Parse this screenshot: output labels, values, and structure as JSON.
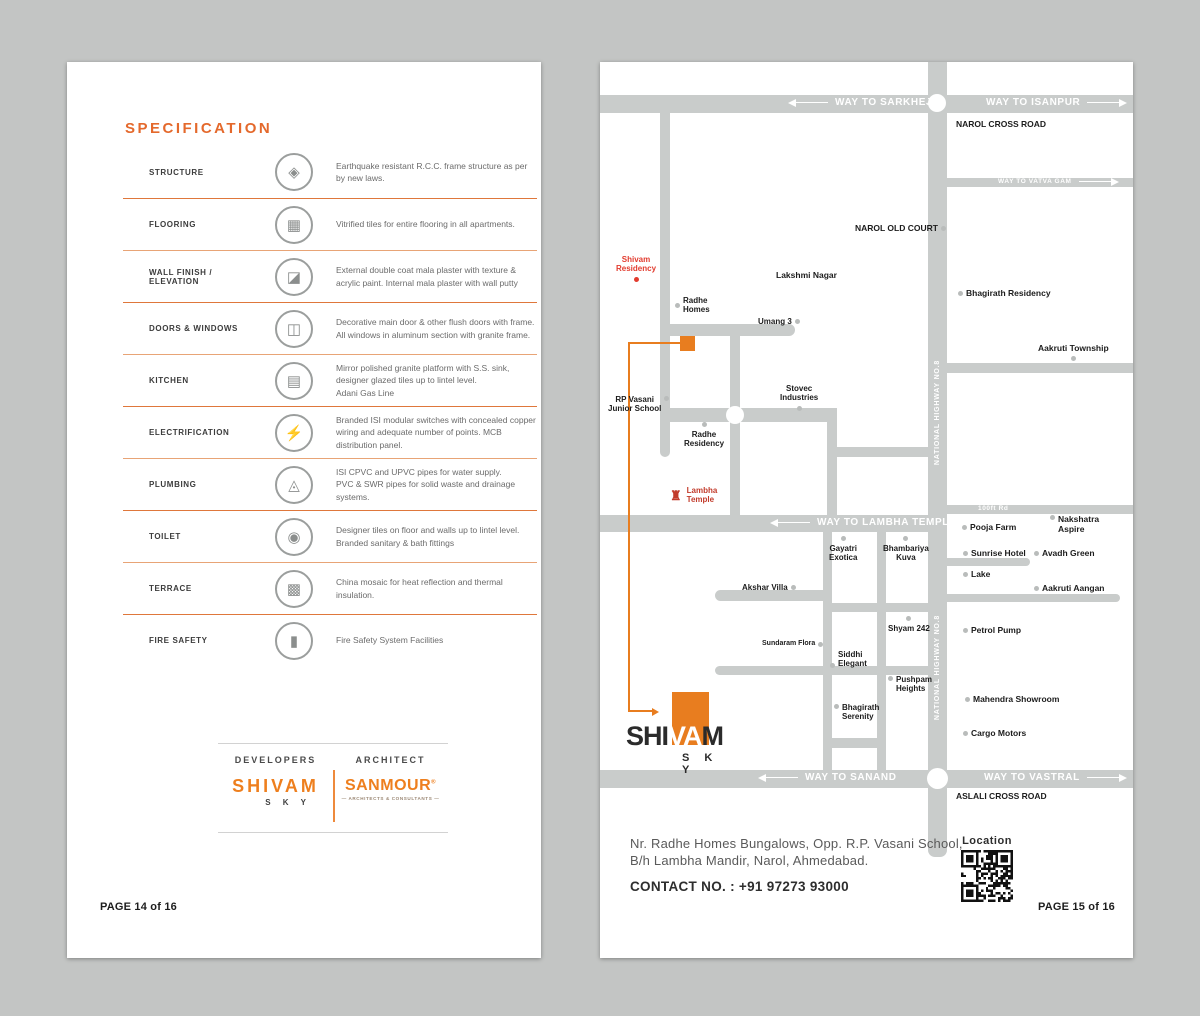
{
  "background": "#c3c5c4",
  "accent": "#e87b2d",
  "left_page": {
    "title": "SPECIFICATION",
    "page_number": "PAGE 14 of 16",
    "developers_label": "DEVELOPERS",
    "architect_label": "ARCHITECT",
    "developer_logo": {
      "name": "SHIVAM",
      "sub": "S K Y"
    },
    "architect_logo": {
      "name": "SANMOUR",
      "reg": "®",
      "tagline": "— ARCHITECTS & CONSULTANTS —"
    },
    "spec_items": [
      {
        "label": "STRUCTURE",
        "icon": "◈",
        "icon_name": "layers-icon",
        "desc": "Earthquake resistant R.C.C. frame structure as per by new laws."
      },
      {
        "label": "FLOORING",
        "icon": "▦",
        "icon_name": "tiles-icon",
        "desc": "Vitrified tiles for entire flooring in all apartments."
      },
      {
        "label": "WALL FINISH / ELEVATION",
        "icon": "◪",
        "icon_name": "plaster-icon",
        "desc": "External double coat mala plaster with texture & acrylic paint. Internal mala plaster with wall putty"
      },
      {
        "label": "DOORS & WINDOWS",
        "icon": "◫",
        "icon_name": "door-icon",
        "desc": "Decorative main door & other flush doors with frame. All windows in aluminum section with granite frame."
      },
      {
        "label": "KITCHEN",
        "icon": "▤",
        "icon_name": "stove-icon",
        "desc": "Mirror polished granite platform with S.S. sink, designer glazed tiles up to lintel level.\nAdani Gas Line"
      },
      {
        "label": "ELECTRIFICATION",
        "icon": "⚡",
        "icon_name": "lightning-icon",
        "desc": "Branded ISI modular switches with concealed copper wiring and adequate number of points. MCB distribution panel."
      },
      {
        "label": "PLUMBING",
        "icon": "◬",
        "icon_name": "shower-icon",
        "desc": "ISI CPVC and UPVC pipes for water supply.\nPVC & SWR pipes for solid waste and drainage systems."
      },
      {
        "label": "TOILET",
        "icon": "◉",
        "icon_name": "toilet-icon",
        "desc": "Designer tiles on floor and walls up to lintel level.\nBranded sanitary & bath fittings"
      },
      {
        "label": "TERRACE",
        "icon": "▩",
        "icon_name": "mosaic-icon",
        "desc": "China mosaic for heat reflection and thermal insulation."
      },
      {
        "label": "FIRE SAFETY",
        "icon": "▮",
        "icon_name": "extinguisher-icon",
        "desc": "Fire Safety System Facilities"
      }
    ]
  },
  "right_page": {
    "page_number": "PAGE 15 of 16",
    "address_line1": "Nr. Radhe Homes Bungalows, Opp. R.P. Vasani School,",
    "address_line2": "B/h Lambha Mandir, Narol, Ahmedabad.",
    "contact": "CONTACT NO. : +91 97273 93000",
    "qr_label": "Location",
    "map": {
      "highway_label": "NATIONAL HIGHWAY NO.8",
      "site_logo": {
        "pre": "SHI",
        "mid": "VA",
        "post": "M",
        "sub": "S K Y"
      },
      "road_labels": [
        {
          "text": "WAY TO SARKHEJ",
          "x": 196,
          "y": 35,
          "arrow": "left",
          "fs": 10
        },
        {
          "text": "WAY TO ISANPUR",
          "x": 386,
          "y": 35,
          "arrow": "right",
          "fs": 10
        },
        {
          "text": "WAY TO VATVA GAM",
          "x": 398,
          "y": 116,
          "arrow": "right",
          "fs": 6.5
        },
        {
          "text": "WAY TO LAMBHA TEMPLE",
          "x": 178,
          "y": 455,
          "arrow": "left",
          "fs": 10
        },
        {
          "text": "100ft Rd",
          "x": 378,
          "y": 443,
          "arrow": "none",
          "fs": 6.5
        },
        {
          "text": "WAY TO SANAND",
          "x": 166,
          "y": 710,
          "arrow": "left",
          "fs": 10
        },
        {
          "text": "WAY TO VASTRAL",
          "x": 384,
          "y": 710,
          "arrow": "right",
          "fs": 10
        }
      ],
      "places": [
        {
          "name": "NAROL CROSS ROAD",
          "x": 356,
          "y": 57,
          "dot": "none",
          "fs": 8.5
        },
        {
          "name": "NAROL OLD COURT",
          "x": 255,
          "y": 161,
          "dot": "right",
          "fs": 8.5
        },
        {
          "name": "Lakshmi Nagar",
          "x": 176,
          "y": 208,
          "dot": "none",
          "fs": 8.5
        },
        {
          "name": "Shivam\nResidency",
          "x": 16,
          "y": 193,
          "dot": "below",
          "red": true,
          "center": true
        },
        {
          "name": "Radhe\nHomes",
          "x": 75,
          "y": 234,
          "dot": "left"
        },
        {
          "name": "Umang 3",
          "x": 158,
          "y": 255,
          "dot": "right"
        },
        {
          "name": "Bhagirath Residency",
          "x": 358,
          "y": 226,
          "dot": "left",
          "fs": 8.5
        },
        {
          "name": "Aakruti Township",
          "x": 438,
          "y": 281,
          "dot": "below",
          "center": true,
          "fs": 8.5
        },
        {
          "name": "RP Vasani\nJunior School",
          "x": 8,
          "y": 333,
          "dot": "right",
          "dotpos": "top",
          "center": true
        },
        {
          "name": "Stovec\nIndustries",
          "x": 180,
          "y": 322,
          "dot": "below",
          "center": true
        },
        {
          "name": "Radhe\nResidency",
          "x": 84,
          "y": 360,
          "dot": "above",
          "center": true
        },
        {
          "name": "Lambha\nTemple",
          "x": 70,
          "y": 424,
          "dot": "temple"
        },
        {
          "name": "Akshar Villa",
          "x": 142,
          "y": 521,
          "dot": "right"
        },
        {
          "name": "Gayatri\nExotica",
          "x": 229,
          "y": 474,
          "dot": "above",
          "center": true
        },
        {
          "name": "Bhambariya\nKuva",
          "x": 283,
          "y": 474,
          "dot": "above",
          "center": true
        },
        {
          "name": "Sundaram Flora",
          "x": 162,
          "y": 578,
          "dot": "right",
          "fs": 7
        },
        {
          "name": "Siddhi\nElegant",
          "x": 230,
          "y": 588,
          "dot": "left",
          "dotpos": "bot"
        },
        {
          "name": "Shyam 242",
          "x": 288,
          "y": 554,
          "dot": "above",
          "center": true
        },
        {
          "name": "Pushpam\nHeights",
          "x": 288,
          "y": 613,
          "dot": "left",
          "dotpos": "top"
        },
        {
          "name": "Bhagirath\nSerenity",
          "x": 234,
          "y": 641,
          "dot": "left",
          "dotpos": "top"
        },
        {
          "name": "Pooja Farm",
          "x": 362,
          "y": 460,
          "dot": "left",
          "fs": 8.5
        },
        {
          "name": "Nakshatra\nAspire",
          "x": 450,
          "y": 452,
          "dot": "left",
          "dotpos": "top",
          "fs": 8.5
        },
        {
          "name": "Sunrise Hotel",
          "x": 363,
          "y": 486,
          "dot": "left",
          "fs": 8.5
        },
        {
          "name": "Avadh Green",
          "x": 434,
          "y": 486,
          "dot": "left",
          "fs": 8.5
        },
        {
          "name": "Lake",
          "x": 363,
          "y": 507,
          "dot": "left",
          "fs": 8.5
        },
        {
          "name": "Aakruti Aangan",
          "x": 434,
          "y": 521,
          "dot": "left",
          "fs": 8.5
        },
        {
          "name": "Petrol Pump",
          "x": 363,
          "y": 563,
          "dot": "left",
          "fs": 8.5
        },
        {
          "name": "Mahendra Showroom",
          "x": 365,
          "y": 632,
          "dot": "left",
          "fs": 8.5
        },
        {
          "name": "Cargo Motors",
          "x": 363,
          "y": 666,
          "dot": "left",
          "fs": 8.5
        },
        {
          "name": "ASLALI CROSS ROAD",
          "x": 356,
          "y": 729,
          "dot": "none",
          "fs": 8.5
        }
      ]
    }
  }
}
